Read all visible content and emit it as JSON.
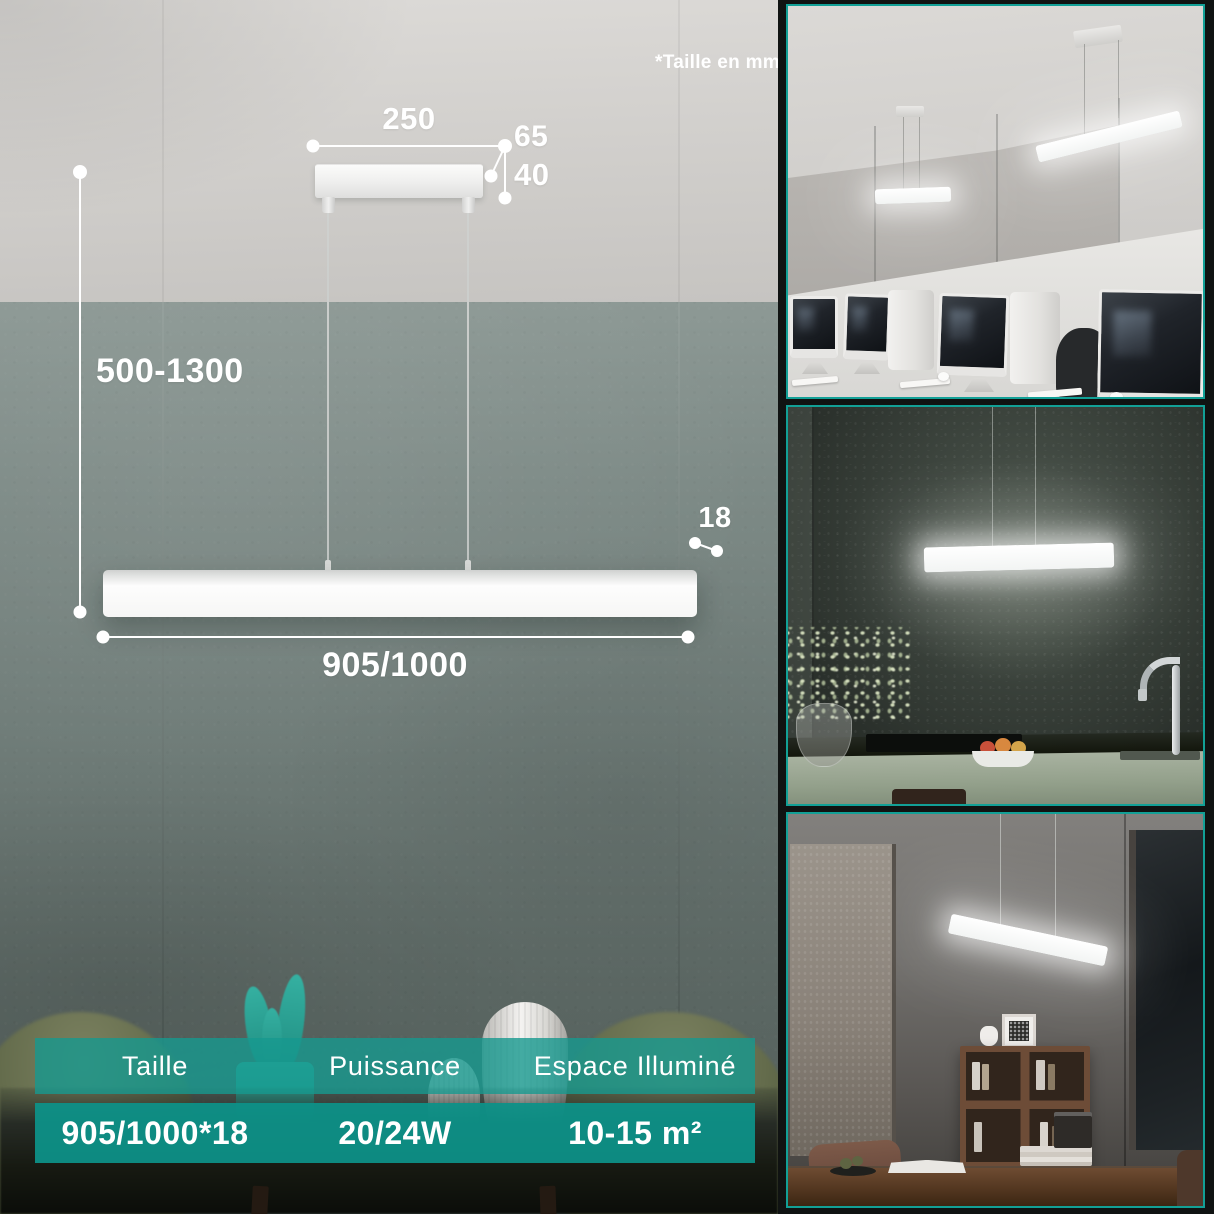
{
  "meta": {
    "note": "*Taille en mm"
  },
  "colors": {
    "accent_teal": "#12988d",
    "photo_border_teal": "#12a096",
    "table_header_teal": "rgba(22,153,143,0.80)",
    "table_value_teal": "rgba(13,146,136,0.94)"
  },
  "diagram": {
    "canopy_width": "250",
    "canopy_depth": "65",
    "canopy_height": "40",
    "suspension_height": "500-1300",
    "bar_thickness": "18",
    "bar_length": "905/1000"
  },
  "spec_table": {
    "headers": [
      "Taille",
      "Puissance",
      "Espace Illuminé"
    ],
    "values": [
      "905/1000*18",
      "20/24W",
      "10-15 m²"
    ]
  }
}
